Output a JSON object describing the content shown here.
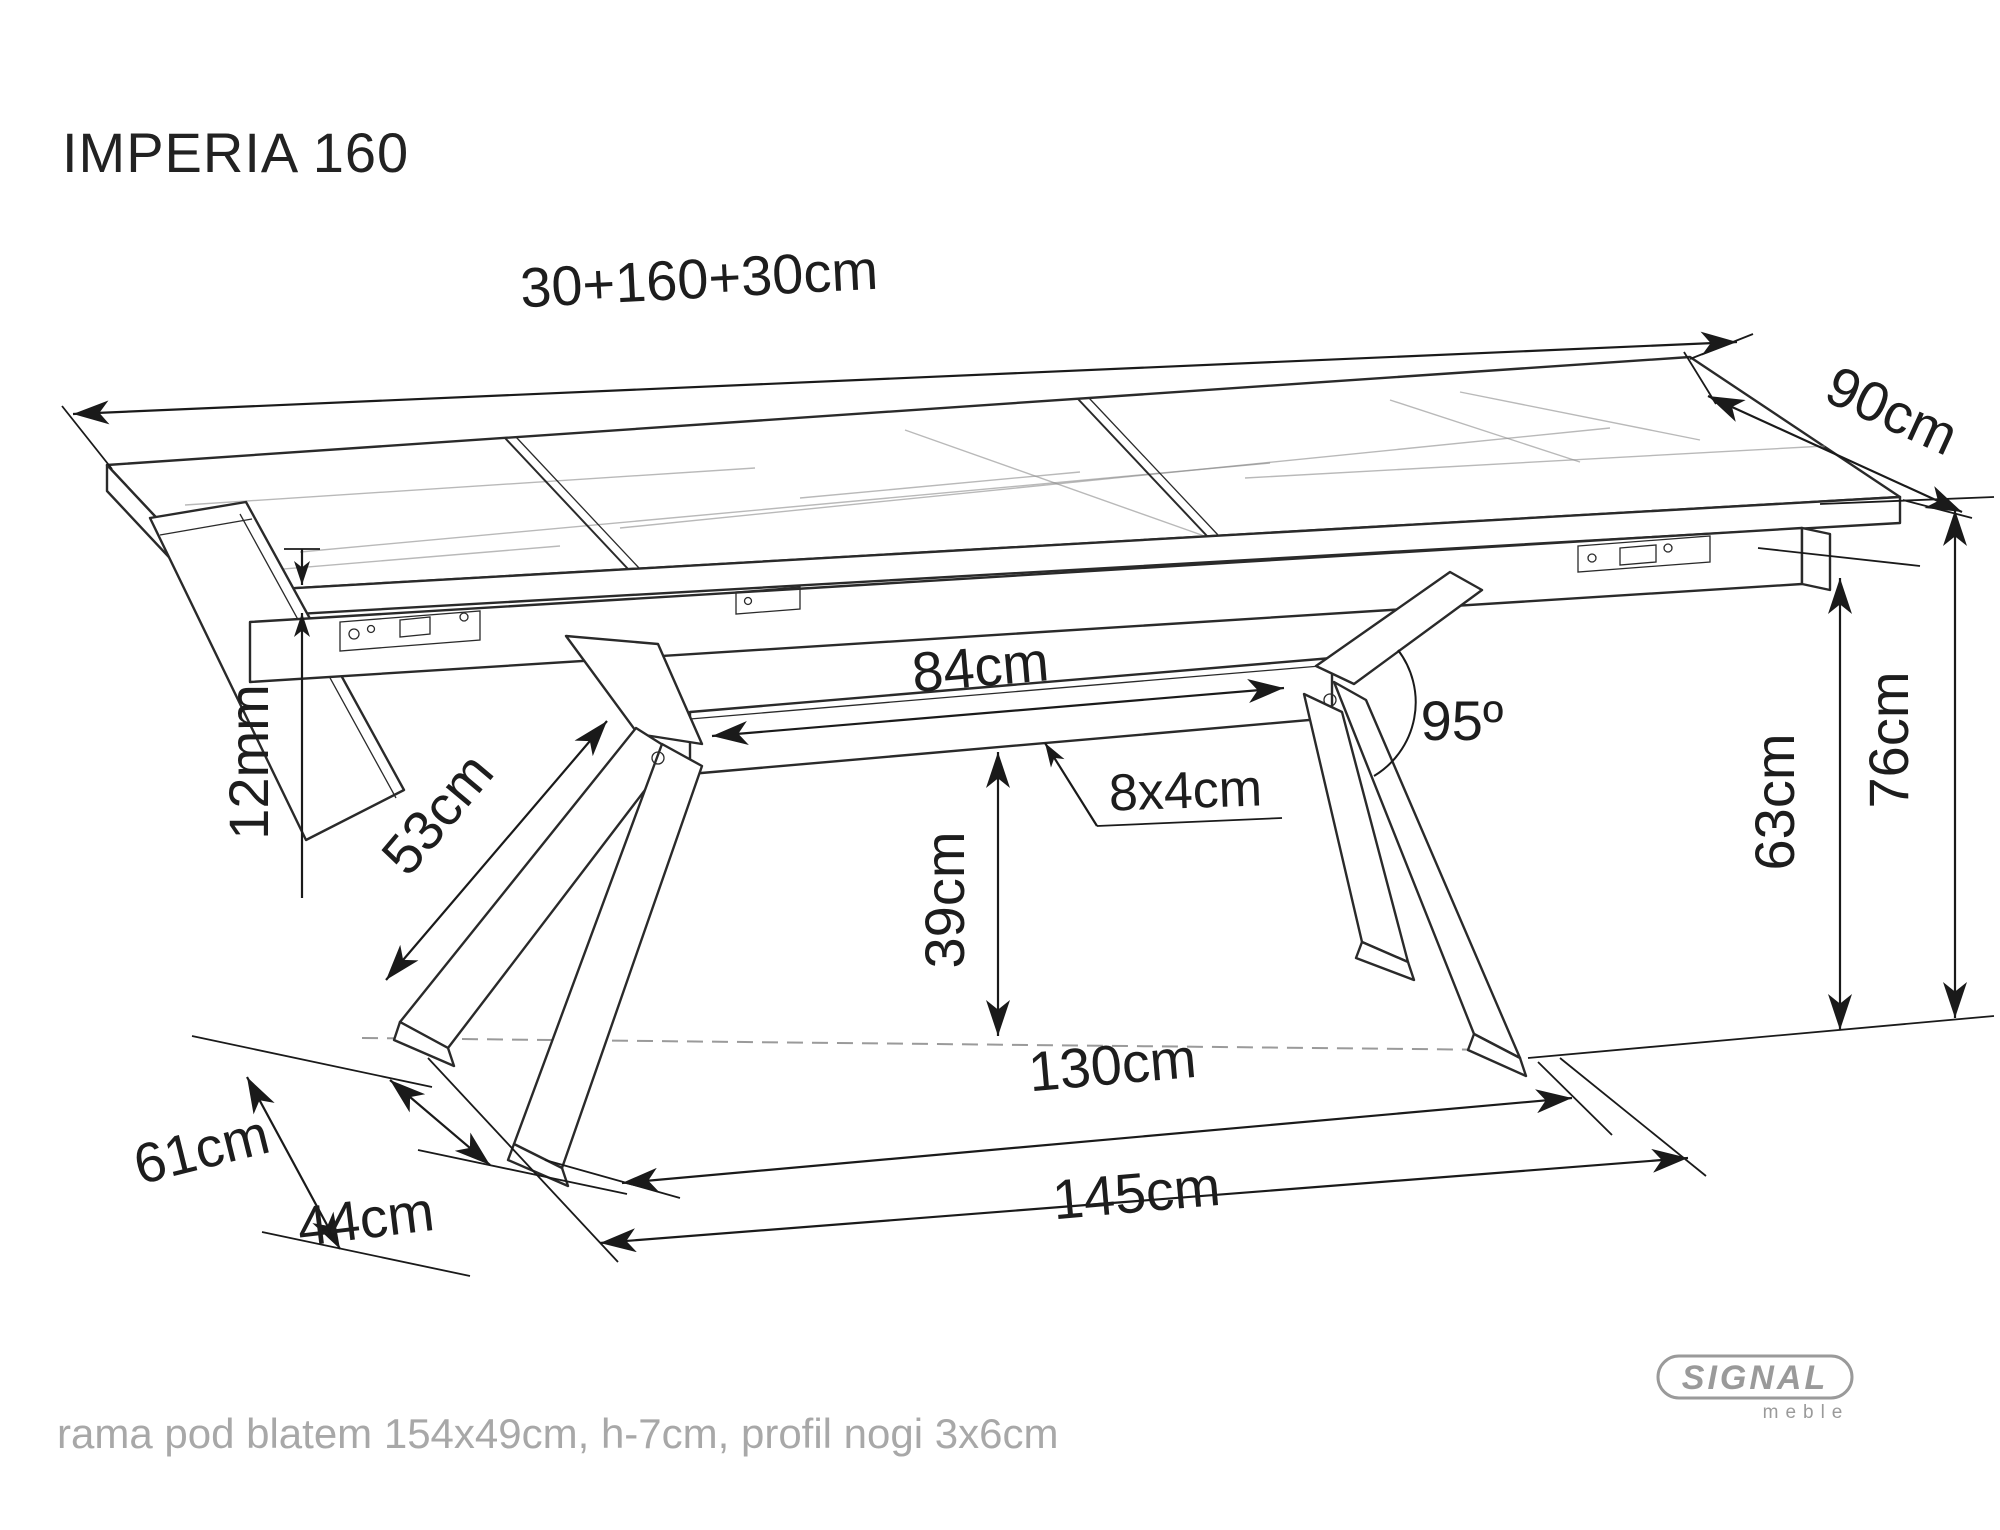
{
  "title": "IMPERIA 160",
  "note": "rama pod blatem 154x49cm, h-7cm, profil nogi 3x6cm",
  "logo": {
    "brand": "SIGNAL",
    "sub": "meble"
  },
  "dimensions": {
    "total_length": "30+160+30cm",
    "width": "90cm",
    "top_thickness": "12mm",
    "beam_length": "84cm",
    "leg_angle": "95º",
    "beam_profile": "8x4cm",
    "leg_length": "53cm",
    "beam_floor_clearance": "39cm",
    "underframe_height": "63cm",
    "table_height": "76cm",
    "foot_depth": "61cm",
    "foot_inner_depth": "44cm",
    "feet_inner_span": "130cm",
    "feet_outer_span": "145cm"
  }
}
